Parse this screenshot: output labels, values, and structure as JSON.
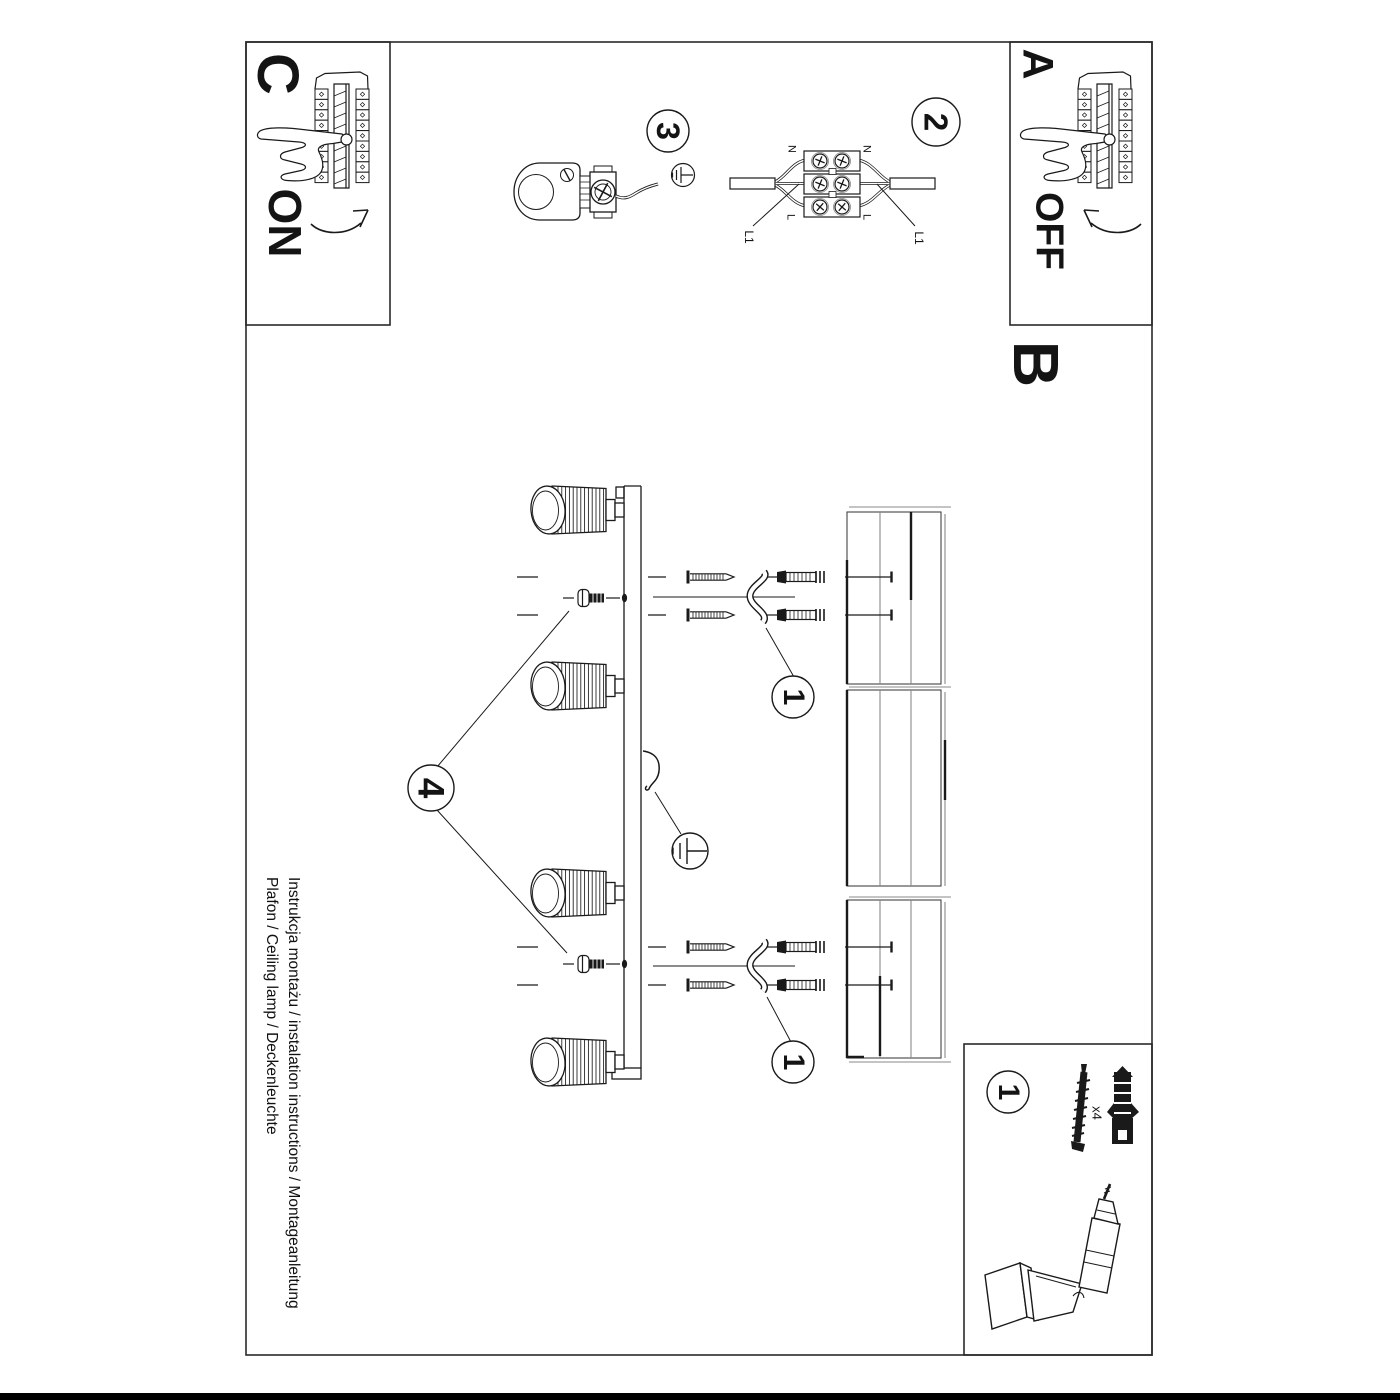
{
  "colors": {
    "ink": "#1a1a1a",
    "paper": "#ffffff",
    "panel_line": "#8a8a8a"
  },
  "sections": {
    "a": "A",
    "b": "B",
    "c": "C"
  },
  "switch_states": {
    "on": "ON",
    "off": "OFF"
  },
  "step_callouts": {
    "step1": "1",
    "step2": "2",
    "step3": "3",
    "step4": "4"
  },
  "wiring_labels": {
    "neutral": "N",
    "live": "L",
    "live1": "L1"
  },
  "hardware": {
    "anchor_quantity": "x4"
  },
  "footer": {
    "line1": "Instrukcja montażu / instalation instructions / Montageanleitung",
    "line2": "Plafon / Ceiling lamp / Deckenleuchte"
  }
}
